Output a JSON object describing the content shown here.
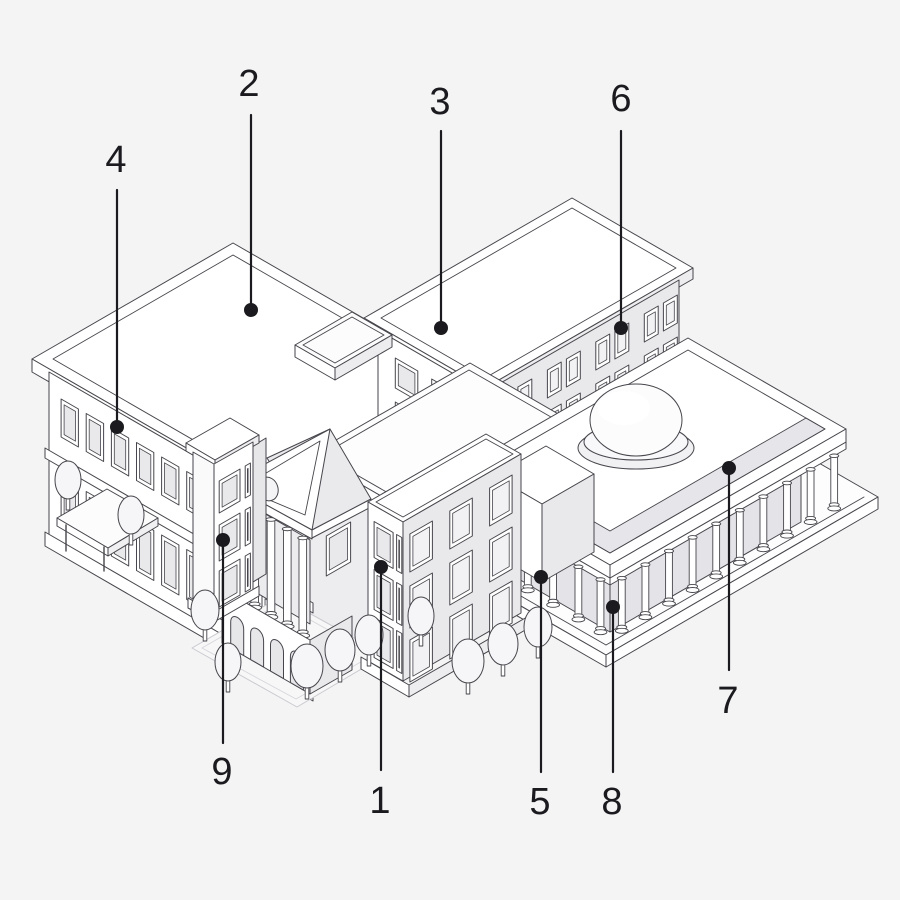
{
  "callouts": [
    {
      "label": "1"
    },
    {
      "label": "2"
    },
    {
      "label": "3"
    },
    {
      "label": "4"
    },
    {
      "label": "5"
    },
    {
      "label": "6"
    },
    {
      "label": "7"
    },
    {
      "label": "8"
    },
    {
      "label": "9"
    }
  ],
  "colors": {
    "background": "#f4f4f5",
    "line": "#46464c",
    "callout": "#1b1b1f",
    "face_light": "#ffffff",
    "face_shaded": "#e9e9ec",
    "roof_band": "#e6e6ea"
  }
}
